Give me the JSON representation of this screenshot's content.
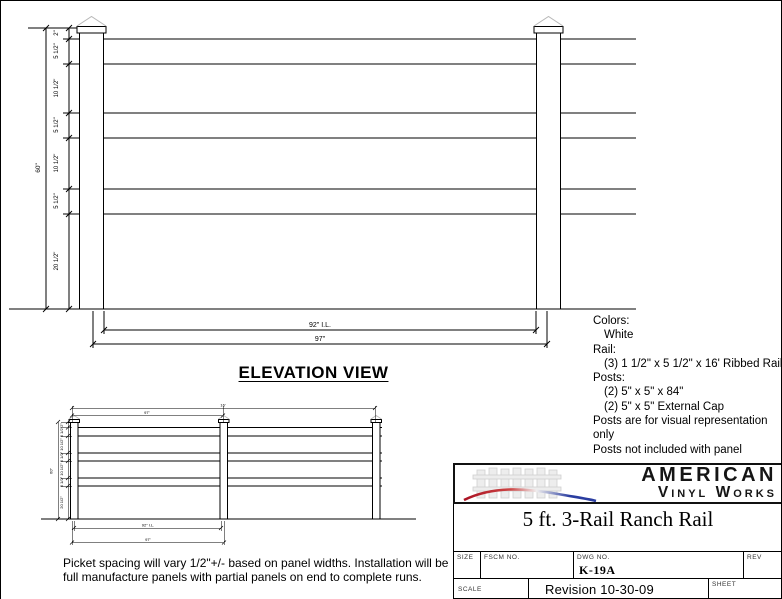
{
  "drawing": {
    "elevation": {
      "title": "ELEVATION VIEW",
      "height_segments": [
        "2\"",
        "5 1/2\"",
        "10 1/2\"",
        "5 1/2\"",
        "10 1/2\"",
        "5 1/2\"",
        "20 1/2\""
      ],
      "overall_height": "60\"",
      "inside_length": "92\" I.L.",
      "panel_length": "97\""
    },
    "small_view": {
      "height_segments": [
        "2\"",
        "5 1/2\"",
        "10 1/2\"",
        "5 1/2\"",
        "10 1/2\"",
        "5 1/2\"",
        "20 1/2\""
      ],
      "overall_height": "60\"",
      "run_length": "16'",
      "bay_length": "97\"",
      "inside_length": "92\" I.L.",
      "panel_length": "97\""
    }
  },
  "specs": {
    "lines": [
      {
        "text": "Colors:"
      },
      {
        "text": "White"
      },
      {
        "text": "Rail:"
      },
      {
        "text": "(3) 1 1/2\" x 5 1/2\" x 16' Ribbed Rail"
      },
      {
        "text": "Posts:"
      },
      {
        "text": "(2) 5\" x 5\" x 84\""
      },
      {
        "text": "(2) 5\" x 5\" External Cap"
      },
      {
        "text": "Posts are for visual representation only"
      },
      {
        "text": "Posts not included with panel"
      }
    ]
  },
  "notes": {
    "text": "Picket spacing will vary 1/2\"+/- based on panel widths.  Installation will be full manufacture panels with partial panels on end to complete runs."
  },
  "title_block": {
    "logo": {
      "line1": "AMERICAN",
      "line2": "Vinyl Works"
    },
    "product_title": "5 ft. 3-Rail Ranch Rail",
    "labels": {
      "size": "SIZE",
      "fscm": "FSCM  NO.",
      "dwg": "DWG  NO.",
      "rev": "REV",
      "scale": "SCALE",
      "sheet": "SHEET"
    },
    "dwg_no": "K-19A",
    "revision": "Revision 10-30-09"
  },
  "colors": {
    "line": "#000000",
    "cap_profile": "#b8b8b8",
    "swoosh_red": "#aa1122",
    "swoosh_blue": "#2a3da0"
  }
}
